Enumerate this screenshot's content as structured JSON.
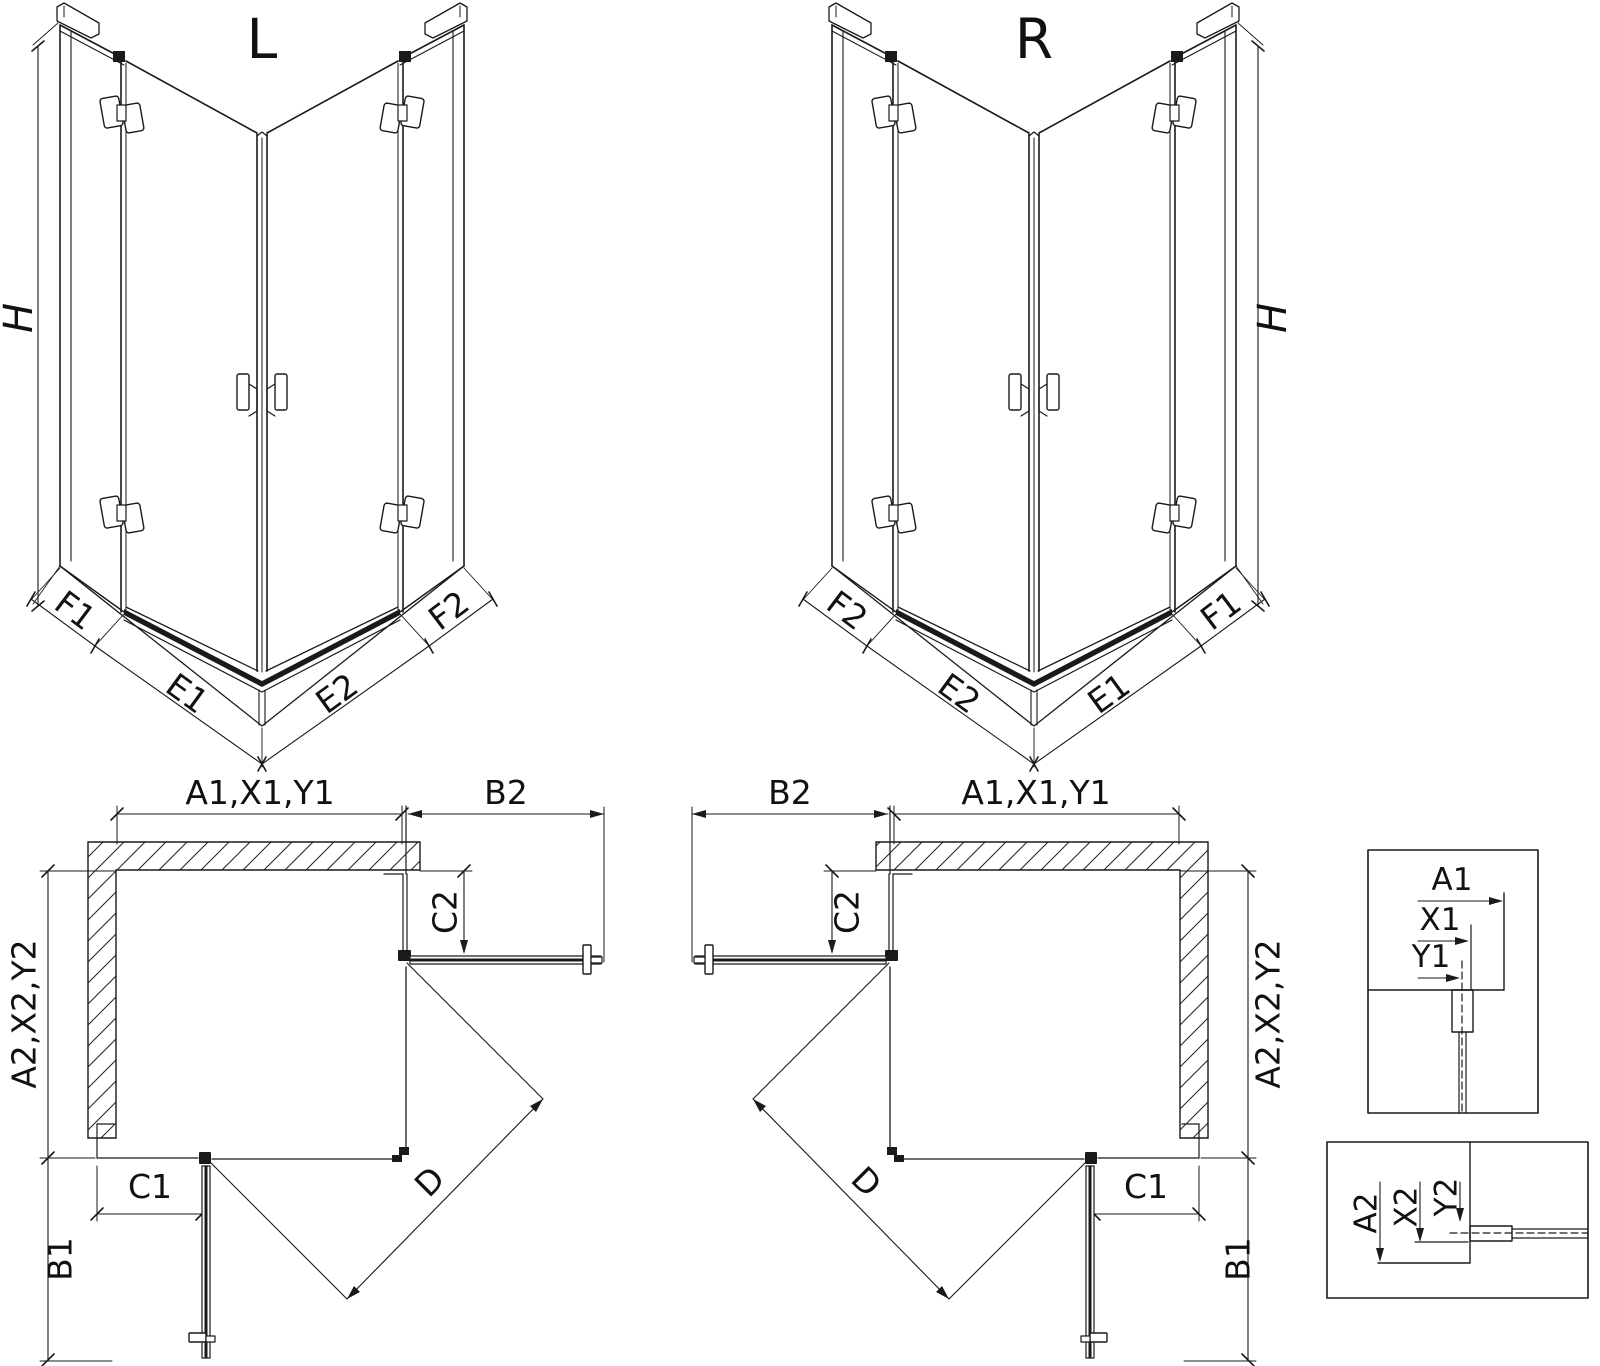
{
  "iso_left": {
    "title": "L",
    "height_label": "H",
    "bottom_dims": {
      "f1": "F1",
      "e1": "E1",
      "e2": "E2",
      "f2": "F2"
    }
  },
  "iso_right": {
    "title": "R",
    "height_label": "H",
    "bottom_dims": {
      "f2": "F2",
      "e2": "E2",
      "e1": "E1",
      "f1": "F1"
    }
  },
  "plan_left": {
    "top_width": "A1,X1,Y1",
    "door_top_width": "B2",
    "fixed_top_depth": "C2",
    "side_width": "A2,X2,Y2",
    "fixed_side_width": "C1",
    "door_side_width": "B1",
    "diagonal_entry": "D"
  },
  "plan_right": {
    "top_width": "A1,X1,Y1",
    "door_top_width": "B2",
    "fixed_top_depth": "C2",
    "side_width": "A2,X2,Y2",
    "fixed_side_width": "C1",
    "door_side_width": "B1",
    "diagonal_entry": "D"
  },
  "detail_top": {
    "labels": [
      "A1",
      "X1",
      "Y1"
    ]
  },
  "detail_bottom": {
    "labels": [
      "A2",
      "X2",
      "Y2"
    ]
  },
  "colors": {
    "line": "#1a1a1a",
    "background": "#ffffff"
  }
}
